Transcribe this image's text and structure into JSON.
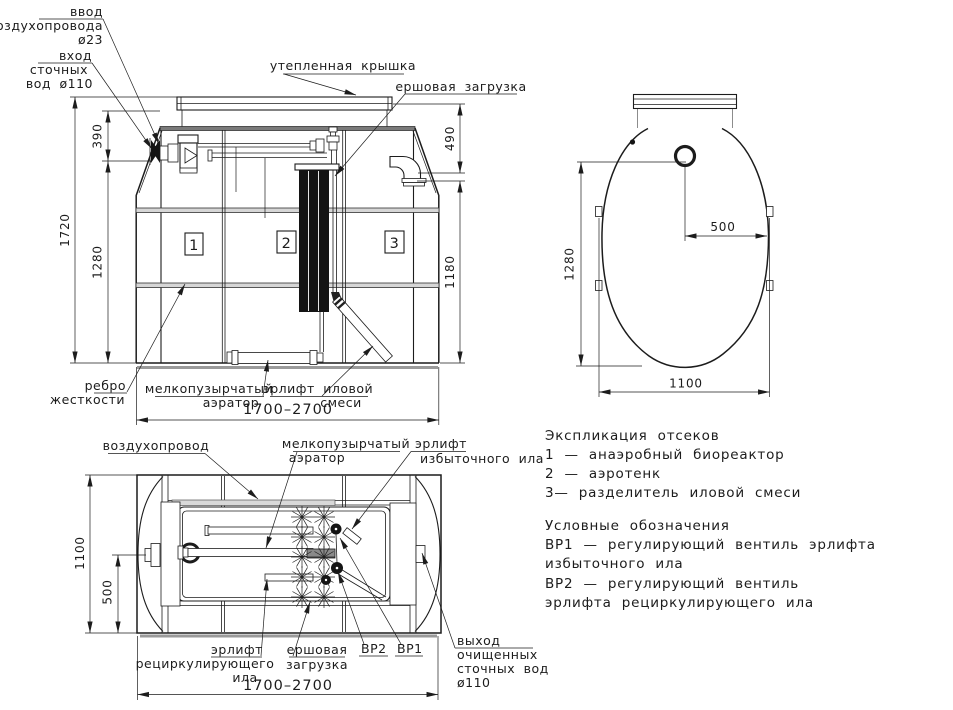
{
  "front": {
    "labels": {
      "air_inlet_1": "ввод",
      "air_inlet_2": "воздухопровода",
      "air_inlet_3": "ø23",
      "inlet_1": "вход",
      "inlet_2": "сточных",
      "inlet_3": "вод ø110",
      "cover": "утепленная крышка",
      "brush": "ершовая загрузка",
      "rib_1": "ребро",
      "rib_2": "жесткости",
      "aerator_1": "мелкопузырчатый",
      "aerator_2": "аэратор",
      "airlift_1": "эрлифт иловой",
      "airlift_2": "смеси"
    },
    "dims": {
      "d390": "390",
      "d1720": "1720",
      "d1280": "1280",
      "d490": "490",
      "d1180": "1180",
      "width": "1700–2700"
    },
    "compartments": {
      "n1": "1",
      "n2": "2",
      "n3": "3"
    }
  },
  "top": {
    "dims": {
      "d1280": "1280",
      "d500": "500",
      "d1100": "1100"
    }
  },
  "plan": {
    "labels": {
      "air_duct": "воздухопровод",
      "aerator_1": "мелкопузырчатый",
      "aerator_2": "аэратор",
      "excess_1": "эрлифт",
      "excess_2": "избыточного ила",
      "recirc_1": "эрлифт",
      "recirc_2": "рециркулирующего",
      "recirc_3": "ила",
      "brush_1": "ершовая",
      "brush_2": "загрузка",
      "vr2": "ВР2",
      "vr1": "ВР1",
      "outlet_1": "выход",
      "outlet_2": "очищенных",
      "outlet_3": "сточных вод",
      "outlet_4": "ø110"
    },
    "dims": {
      "d1100": "1100",
      "d500": "500",
      "width": "1700–2700"
    }
  },
  "legend": {
    "heading_compartments": "Экспликация отсеков",
    "compartment_1": "1 — анаэробный биореактор",
    "compartment_2": "2 — аэротенк",
    "compartment_3": "3— разделитель иловой смеси",
    "heading_symbols": "Условные обозначения",
    "symbol_vr1a": "ВР1 — регулирующий вентиль эрлифта",
    "symbol_vr1b": "избыточного ила",
    "symbol_vr2a": "ВР2 — регулирующий вентиль",
    "symbol_vr2b": "эрлифта рециркулирующего ила"
  },
  "colors": {
    "line": "#1c1c1c",
    "gray": "#6f6f6f",
    "shadow": "#9a9a9a"
  }
}
